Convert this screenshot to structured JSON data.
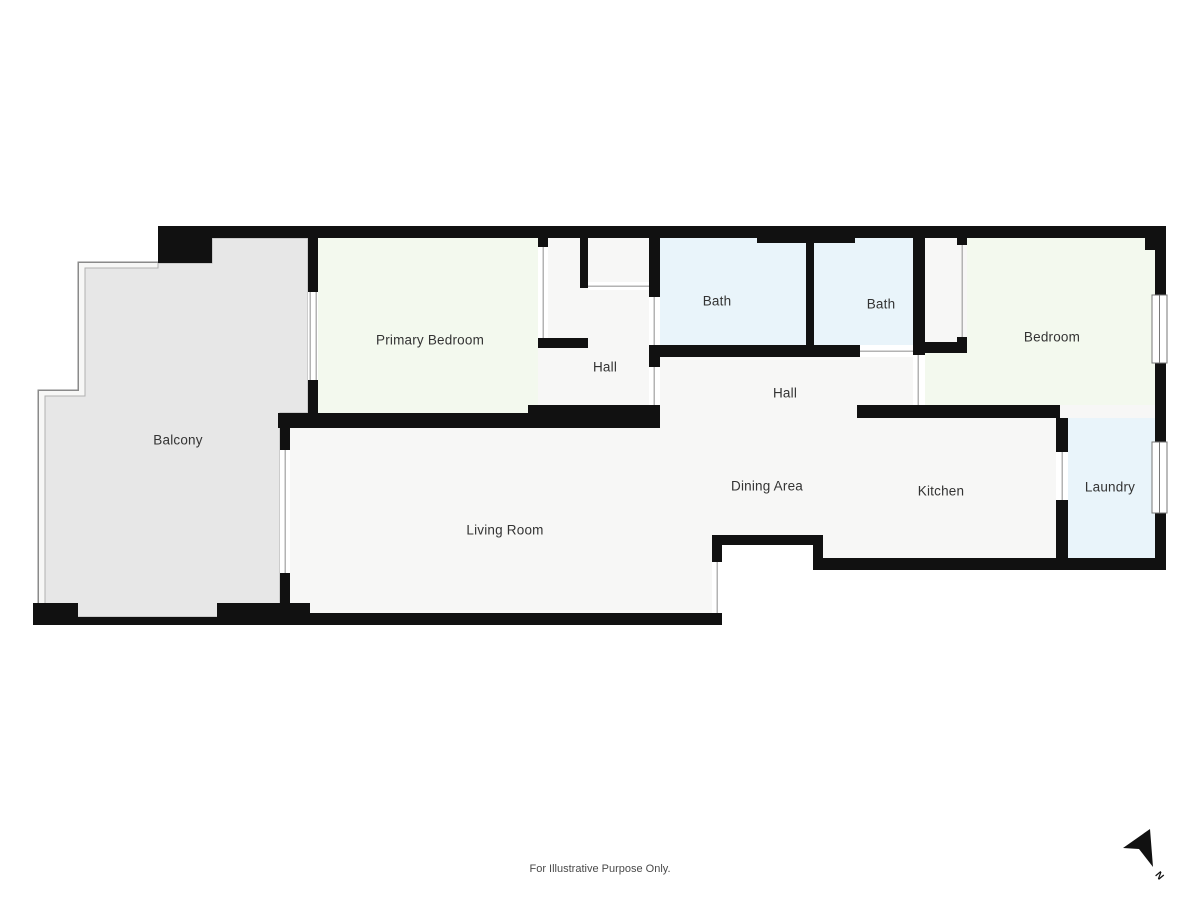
{
  "plan": {
    "rooms": [
      {
        "label": "Balcony"
      },
      {
        "label": "Primary Bedroom"
      },
      {
        "label": "Hall"
      },
      {
        "label": "Bath"
      },
      {
        "label": "Bath"
      },
      {
        "label": "Bedroom"
      },
      {
        "label": "Hall"
      },
      {
        "label": "Dining Area"
      },
      {
        "label": "Kitchen"
      },
      {
        "label": "Laundry"
      },
      {
        "label": "Living Room"
      }
    ],
    "disclaimer": "For Illustrative Purpose Only.",
    "compass": {
      "label": "N"
    },
    "colors": {
      "wall": "#111111",
      "room_fill": "#f7f7f6",
      "balcony_fill": "#e7e7e7",
      "bath_fill": "#e9f4fa",
      "bedroom_fill": "#f3f9ee",
      "railing_line": "#8a8a8a",
      "opening_line": "#b3b3b3"
    }
  }
}
